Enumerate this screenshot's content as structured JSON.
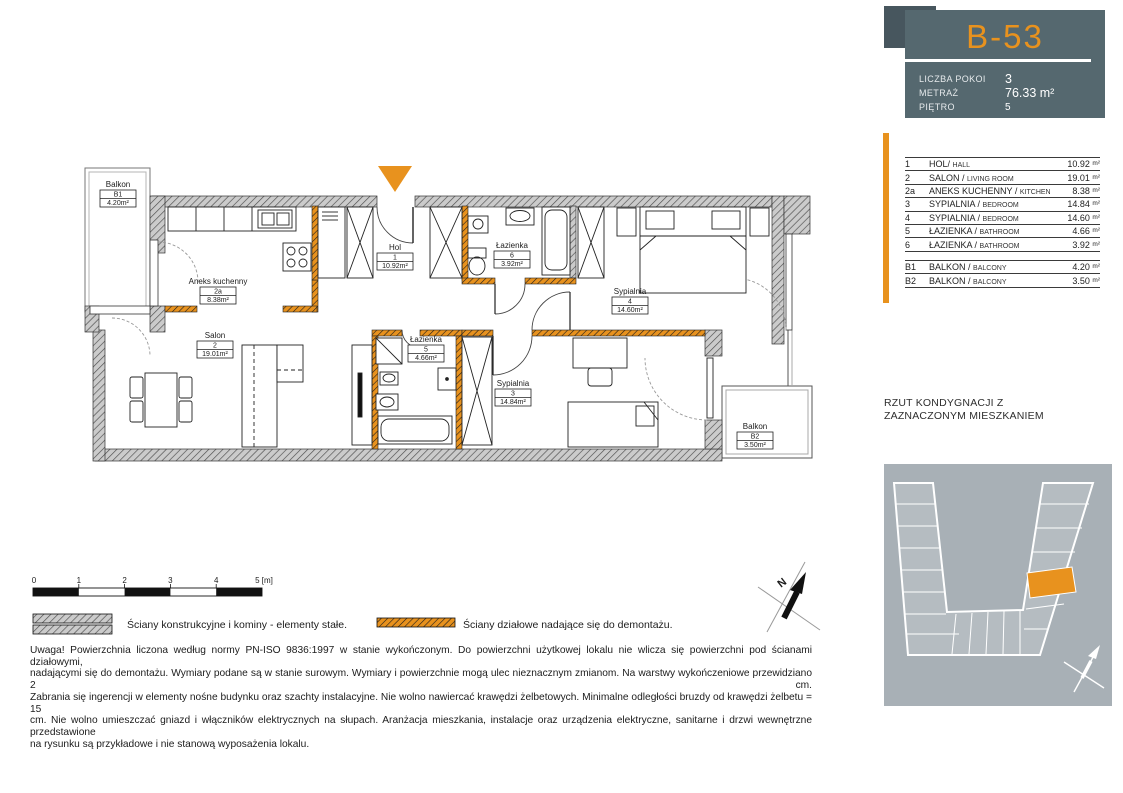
{
  "colors": {
    "accent": "#E8921E",
    "card_bg": "#55686F",
    "card_bg_dark": "#47565E",
    "map_bg": "#A8B0B6",
    "map_building": "#B5BCC1"
  },
  "card": {
    "unit": "B-53",
    "rows": [
      {
        "label": "LICZBA POKOI",
        "value": "3"
      },
      {
        "label": "METRAŻ",
        "value": "76.33 m²"
      },
      {
        "label": "PIĘTRO",
        "value": "5"
      }
    ]
  },
  "room_table": {
    "rows": [
      {
        "no": "1",
        "name": "HOL/",
        "en": "HALL",
        "area": "10.92",
        "unit": "m²"
      },
      {
        "no": "2",
        "name": "SALON /",
        "en": "LIVING ROOM",
        "area": "19.01",
        "unit": "m²"
      },
      {
        "no": "2a",
        "name": "ANEKS KUCHENNY /",
        "en": "KITCHEN",
        "area": "8.38",
        "unit": "m²"
      },
      {
        "no": "3",
        "name": "SYPIALNIA /",
        "en": "BEDROOM",
        "area": "14.84",
        "unit": "m²"
      },
      {
        "no": "4",
        "name": "SYPIALNIA /",
        "en": "BEDROOM",
        "area": "14.60",
        "unit": "m²"
      },
      {
        "no": "5",
        "name": "ŁAZIENKA /",
        "en": "BATHROOM",
        "area": "4.66",
        "unit": "m²"
      },
      {
        "no": "6",
        "name": "ŁAZIENKA /",
        "en": "BATHROOM",
        "area": "3.92",
        "unit": "m²"
      }
    ],
    "balcony_rows": [
      {
        "no": "B1",
        "name": "BALKON /",
        "en": "BALCONY",
        "area": "4.20",
        "unit": "m²"
      },
      {
        "no": "B2",
        "name": "BALKON /",
        "en": "BALCONY",
        "area": "3.50",
        "unit": "m²"
      }
    ]
  },
  "floor_plan_caption": [
    "RZUT KONDYGNACJI Z",
    "ZAZNACZONYM MIESZKANIEM"
  ],
  "plan": {
    "north_label": "N",
    "rooms": [
      {
        "name": "Balkon",
        "no": "B1",
        "area": "4.20m²"
      },
      {
        "name": "Aneks kuchenny",
        "no": "2a",
        "area": "8.38m²"
      },
      {
        "name": "Salon",
        "no": "2",
        "area": "19.01m²"
      },
      {
        "name": "Hol",
        "no": "1",
        "area": "10.92m²"
      },
      {
        "name": "Łazienka",
        "no": "6",
        "area": "3.92m²"
      },
      {
        "name": "Sypialnia",
        "no": "4",
        "area": "14.60m²"
      },
      {
        "name": "Łazienka",
        "no": "5",
        "area": "4.66m²"
      },
      {
        "name": "Sypialnia",
        "no": "3",
        "area": "14.84m²"
      },
      {
        "name": "Balkon",
        "no": "B2",
        "area": "3.50m²"
      }
    ]
  },
  "scale_bar": {
    "ticks": [
      "0",
      "1",
      "2",
      "3",
      "4"
    ],
    "last_tick": "5 [m]"
  },
  "legend": [
    {
      "label": "Ściany konstrukcyjne i kominy - elementy stałe."
    },
    {
      "label": "Ściany działowe nadające się do demontażu."
    }
  ],
  "disclaimer": [
    "Uwaga! Powierzchnia liczona według normy PN-ISO 9836:1997 w stanie wykończonym. Do powierzchni użytkowej lokalu nie wlicza się powierzchni pod ścianami działowymi,",
    "nadającymi się do demontażu.  Wymiary podane są w stanie surowym. Wymiary i powierzchnie mogą ulec nieznacznym zmianom. Na warstwy wykończeniowe przewidziano 2 cm.",
    "Zabrania się ingerencji w elementy nośne budynku oraz szachty instalacyjne.  Nie wolno nawiercać krawędzi żelbetowych. Minimalne odległości bruzdy od krawędzi żelbetu = 15",
    "cm. Nie wolno umieszczać gniazd i włączników elektrycznych na słupach. Aranżacja mieszkania, instalacje oraz urządzenia elektryczne, sanitarne i drzwi wewnętrzne przedstawione",
    "na rysunku są przykładowe i nie stanową wyposażenia lokalu."
  ]
}
